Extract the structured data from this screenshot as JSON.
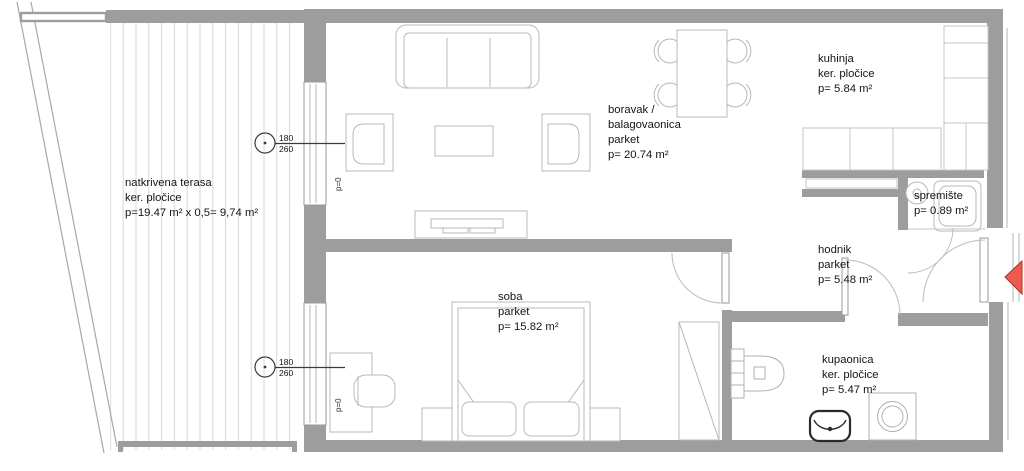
{
  "plan": {
    "title": "apartment floor plan",
    "rooms": {
      "terasa": {
        "line1": "natkrivena terasa",
        "line2": "ker. pločice",
        "line3": "p=19.47 m² x 0,5= 9,74 m²"
      },
      "boravak": {
        "line1": "boravak /",
        "line2": "balagovaonica",
        "line3": "parket",
        "line4": "p= 20.74 m²"
      },
      "kuhinja": {
        "line1": "kuhinja",
        "line2": "ker. pločice",
        "line3": "p= 5.84 m²"
      },
      "spremiste": {
        "line1": "spremište",
        "line2": "p= 0.89 m²"
      },
      "hodnik": {
        "line1": "hodnik",
        "line2": "parket",
        "line3": "p= 5.48 m²"
      },
      "soba": {
        "line1": "soba",
        "line2": "parket",
        "line3": "p= 15.82 m²"
      },
      "kupaonica": {
        "line1": "kupaonica",
        "line2": "ker. pločice",
        "line3": "p= 5.47 m²"
      }
    },
    "window_marker": {
      "top": "180",
      "bottom": "260"
    },
    "parapet_label": "p=0",
    "colors": {
      "wall": "#9d9d9d",
      "furniture_line": "#b8b8b8",
      "deck_line": "#d6d6d6",
      "accent_red": "#ee5a4e",
      "accent_red_border": "#a83428",
      "marker_line": "#3a3a3a"
    }
  }
}
